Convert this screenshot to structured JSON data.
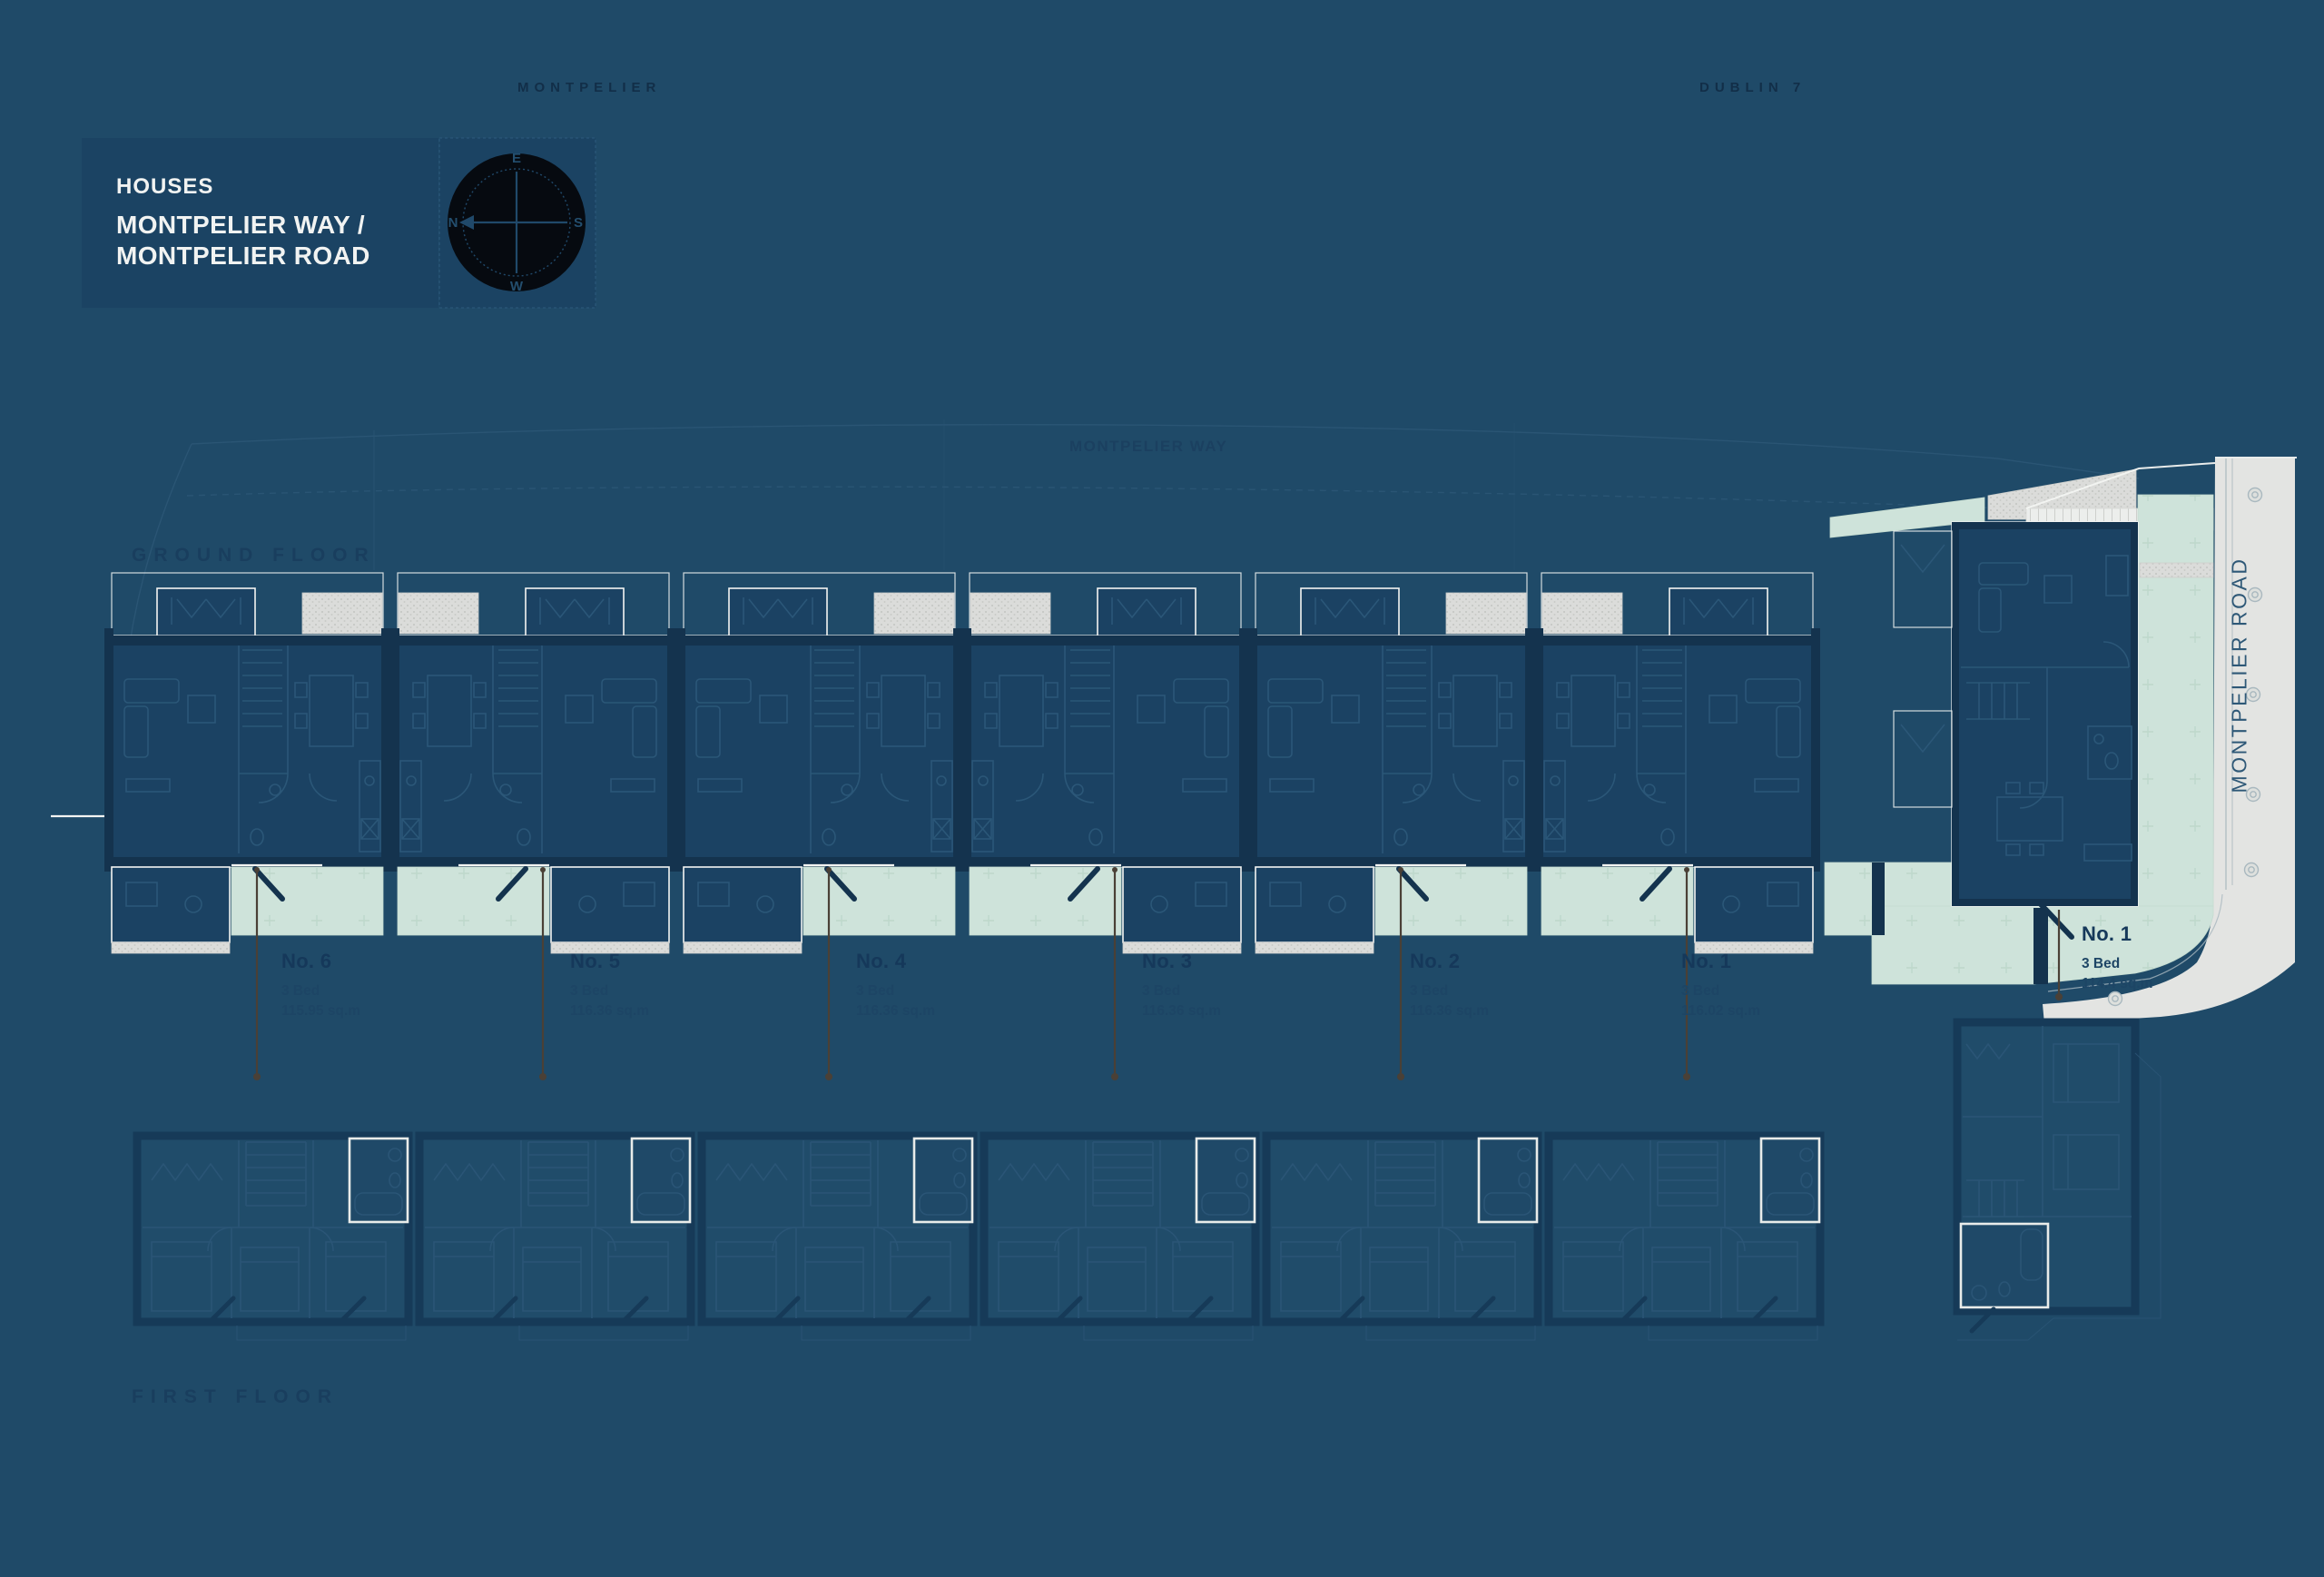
{
  "project": {
    "type_label": "HOUSES",
    "title_line_2": "MONTPELIER WAY /",
    "title_line_3": "MONTPELIER ROAD"
  },
  "compass": {
    "top": "E",
    "right": "S",
    "bottom": "W",
    "left": "N"
  },
  "context_labels": {
    "top_left": "MONTPELIER",
    "top_right": "DUBLIN 7"
  },
  "streets": {
    "horizontal": "MONTPELIER WAY",
    "vertical": "MONTPELIER ROAD"
  },
  "floor_titles": {
    "ground": "GROUND FLOOR",
    "first": "FIRST FLOOR"
  },
  "houses": [
    {
      "no": "No. 6",
      "beds": "3 Bed",
      "area": "115.95 sq.m"
    },
    {
      "no": "No. 5",
      "beds": "3 Bed",
      "area": "116.36 sq.m"
    },
    {
      "no": "No. 4",
      "beds": "3 Bed",
      "area": "116.36 sq.m"
    },
    {
      "no": "No. 3",
      "beds": "3 Bed",
      "area": "116.36 sq.m"
    },
    {
      "no": "No. 2",
      "beds": "3 Bed",
      "area": "116.36 sq.m"
    },
    {
      "no": "No. 1",
      "beds": "3 Bed",
      "area": "116.02 sq.m"
    }
  ],
  "corner_house": {
    "no": "No. 1",
    "beds": "3 Bed",
    "area": "114.4 sq.m"
  },
  "colors": {
    "background_navy": "#1F4A68",
    "plan_fill_navy": "#1B4263",
    "wall_navy": "#14334E",
    "line_blue": "#2B5778",
    "outline_white": "#F3F4F2",
    "garden_mint": "#CEE3DA",
    "road_gray": "#E3E4E2",
    "leader_brown": "#4A4036",
    "panel_navy": "#1B4363",
    "compass_black": "#060A10"
  }
}
